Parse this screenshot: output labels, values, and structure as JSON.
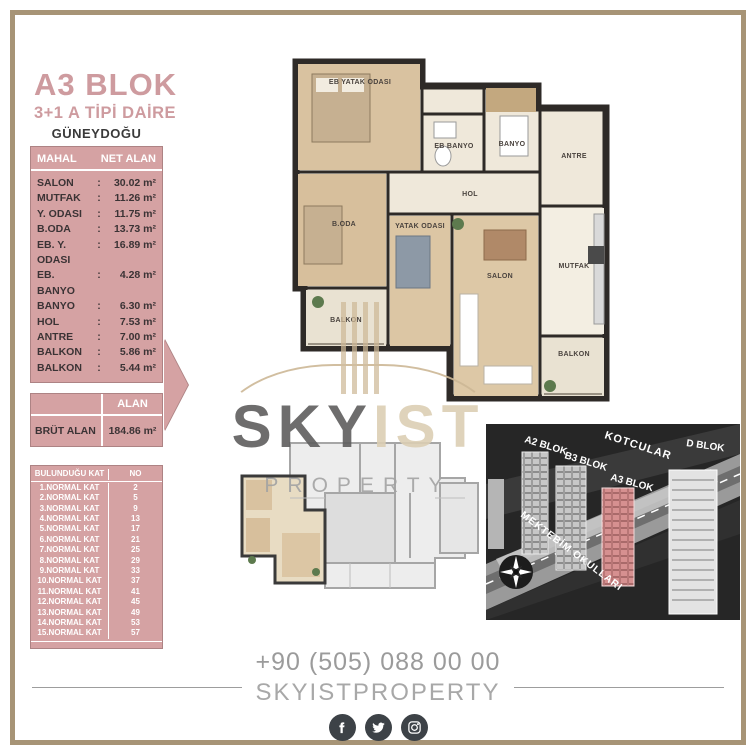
{
  "header": {
    "block_title": "A3 BLOK",
    "unit_type": "3+1 A TİPİ DAİRE",
    "orientation": "GÜNEYDOĞU"
  },
  "separator": ":",
  "area_table": {
    "col_room": "MAHAL",
    "col_area": "NET ALAN",
    "rows": [
      {
        "label": "SALON",
        "value": "30.02 m²"
      },
      {
        "label": "MUTFAK",
        "value": "11.26 m²"
      },
      {
        "label": "Y. ODASI",
        "value": "11.75 m²"
      },
      {
        "label": "B.ODA",
        "value": "13.73 m²"
      },
      {
        "label": "EB. Y. ODASI",
        "value": "16.89 m²"
      },
      {
        "label": "EB. BANYO",
        "value": "4.28 m²"
      },
      {
        "label": "BANYO",
        "value": "6.30 m²"
      },
      {
        "label": "HOL",
        "value": "7.53 m²"
      },
      {
        "label": "ANTRE",
        "value": "7.00 m²"
      },
      {
        "label": "BALKON",
        "value": "5.86 m²"
      },
      {
        "label": "BALKON",
        "value": "5.44 m²"
      }
    ]
  },
  "gross_table": {
    "header": "ALAN",
    "label": "BRÜT ALAN",
    "value": "184.86 m²"
  },
  "floor_table": {
    "col_floor": "BULUNDUĞU KAT",
    "col_no": "NO",
    "rows": [
      {
        "floor": "1.NORMAL KAT",
        "no": "2"
      },
      {
        "floor": "2.NORMAL KAT",
        "no": "5"
      },
      {
        "floor": "3.NORMAL KAT",
        "no": "9"
      },
      {
        "floor": "4.NORMAL KAT",
        "no": "13"
      },
      {
        "floor": "5.NORMAL KAT",
        "no": "17"
      },
      {
        "floor": "6.NORMAL KAT",
        "no": "21"
      },
      {
        "floor": "7.NORMAL KAT",
        "no": "25"
      },
      {
        "floor": "8.NORMAL KAT",
        "no": "29"
      },
      {
        "floor": "9.NORMAL KAT",
        "no": "33"
      },
      {
        "floor": "10.NORMAL KAT",
        "no": "37"
      },
      {
        "floor": "11.NORMAL KAT",
        "no": "41"
      },
      {
        "floor": "12.NORMAL KAT",
        "no": "45"
      },
      {
        "floor": "13.NORMAL KAT",
        "no": "49"
      },
      {
        "floor": "14.NORMAL KAT",
        "no": "53"
      },
      {
        "floor": "15.NORMAL KAT",
        "no": "57"
      }
    ]
  },
  "floorplan": {
    "rooms": [
      "EB YATAK ODASI",
      "EB BANYO",
      "BANYO",
      "ANTRE",
      "HOL",
      "B.ODA",
      "YATAK ODASI",
      "SALON",
      "MUTFAK",
      "BALKON",
      "BALKON"
    ]
  },
  "watermark": {
    "sky": "SKY",
    "ist": "IST",
    "property": "PROPERTY"
  },
  "site_view": {
    "street_top": "KOTCULAR",
    "street_diagonal": "MEKTEBİM OKULLARI",
    "blocks": [
      "A2 BLOK",
      "B3 BLOK",
      "A3 BLOK",
      "D BLOK"
    ],
    "highlight_color": "#d08a8a"
  },
  "footer": {
    "phone": "+90 (505) 088 00 00",
    "brand": "SKYISTPROPERTY",
    "social": [
      "facebook",
      "twitter",
      "instagram"
    ]
  },
  "colors": {
    "accent_pink": "#d5a2a3",
    "accent_pink_border": "#ad8384",
    "frame_tan": "#a79476"
  }
}
